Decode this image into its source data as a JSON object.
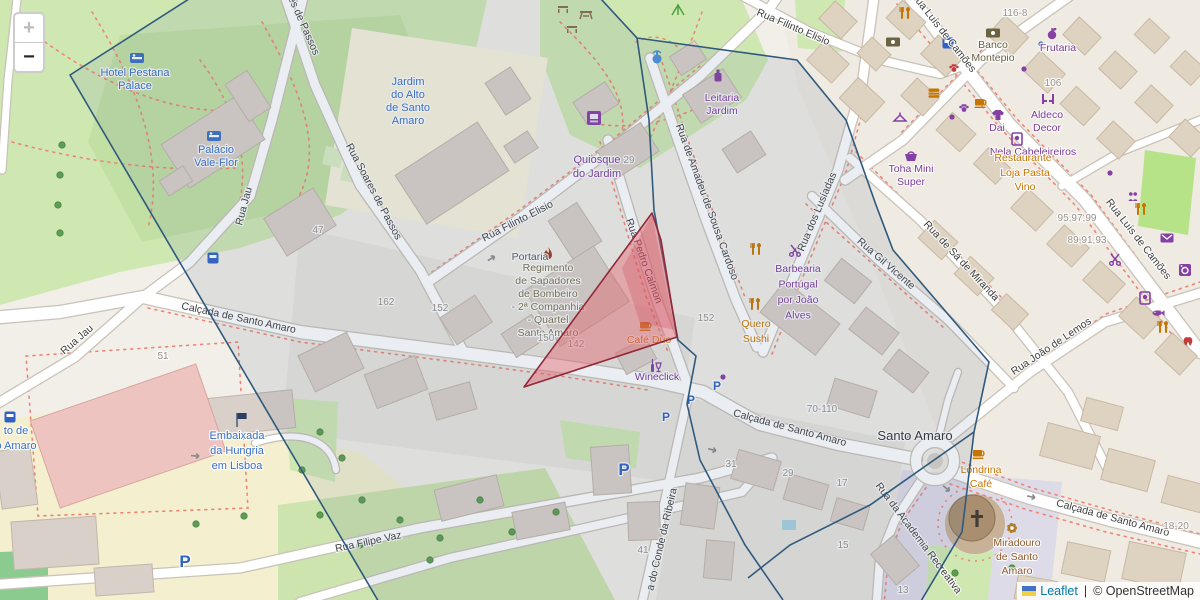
{
  "controls": {
    "zoom_in": "+",
    "zoom_out": "−",
    "zoom_in_enabled": false,
    "zoom_out_enabled": true
  },
  "attribution": {
    "leaflet_link": "Leaflet",
    "separator": "|",
    "copyright": "© OpenStreetMap",
    "flag_icon": "ukraine-flag"
  },
  "colors": {
    "street": "#3e3e3e",
    "shop": "#7a3b99",
    "food": "#c77400",
    "blue": "#3a6fc4",
    "olive": "#6b6243",
    "mil": "#7b6f4d",
    "gray": "#5a5a52",
    "brown": "#8d5b2a",
    "place": "#35343a",
    "num": "#97918a",
    "parking": "#2f62c4",
    "overlay_blue_stroke": "#2f5a7d",
    "overlay_blue_fill": "rgba(90,115,150,0.13)",
    "overlay_red_stroke": "#93283a",
    "overlay_red_fill": "rgba(228,92,103,0.42)"
  },
  "labels": {
    "streets": [
      {
        "t": "Rua Jau",
        "x": 79,
        "y": 342,
        "r": -41
      },
      {
        "t": "Rua Jau",
        "x": 247,
        "y": 207,
        "r": -75
      },
      {
        "t": "es de Passos",
        "x": 301,
        "y": 27,
        "r": 66
      },
      {
        "t": "Rua Soares de Passos",
        "x": 371,
        "y": 193,
        "r": 62
      },
      {
        "t": "Rua Filinto Elisio",
        "x": 519,
        "y": 224,
        "r": -27
      },
      {
        "t": "Rua Filinto Elisio",
        "x": 792,
        "y": 30,
        "r": 23
      },
      {
        "t": "Rua Pedro Calmon",
        "x": 641,
        "y": 262,
        "r": 70
      },
      {
        "t": "Rua de Amadeu de Sousa Cardoso",
        "x": 704,
        "y": 203,
        "r": 70
      },
      {
        "t": "Rua dos Lusíadas",
        "x": 820,
        "y": 213,
        "r": -67
      },
      {
        "t": "Rua Gil Vicente",
        "x": 884,
        "y": 266,
        "r": 41
      },
      {
        "t": "Rua de Sá de Miranda",
        "x": 959,
        "y": 263,
        "r": 47
      },
      {
        "t": "Rua João de Lemos",
        "x": 1053,
        "y": 349,
        "r": -34
      },
      {
        "t": "Rua Luís de Camões",
        "x": 941,
        "y": 34,
        "r": 52
      },
      {
        "t": "Rua Luís de Camões",
        "x": 1136,
        "y": 241,
        "r": 52
      },
      {
        "t": "Calçada de Santo Amaro",
        "x": 238,
        "y": 321,
        "r": 12
      },
      {
        "t": "Calçada de Santo Amaro",
        "x": 789,
        "y": 431,
        "r": 15
      },
      {
        "t": "Calçada de Santo Amaro",
        "x": 1112,
        "y": 521,
        "r": 15
      },
      {
        "t": "Rua Filipe Vaz",
        "x": 369,
        "y": 545,
        "r": -12
      },
      {
        "t": "a do Conde da Ribeira",
        "x": 665,
        "y": 540,
        "r": -77
      },
      {
        "t": "Rua da Academia Recreativa",
        "x": 916,
        "y": 540,
        "r": 53
      }
    ],
    "pois": [
      {
        "l": [
          "Hotel Pestana",
          "Palace"
        ],
        "x": 135,
        "y": 76,
        "lh": 13,
        "c": "blue",
        "s": 11
      },
      {
        "l": [
          "Palácio",
          "Vale-Flor"
        ],
        "x": 216,
        "y": 153,
        "lh": 13,
        "c": "blue",
        "s": 11
      },
      {
        "l": [
          "Jardim",
          "do Alto",
          "de Santo",
          "Amaro"
        ],
        "x": 408,
        "y": 85,
        "lh": 13,
        "c": "blue",
        "s": 11
      },
      {
        "l": [
          "Embaixada",
          "da Hungria",
          "em Lisboa"
        ],
        "x": 237,
        "y": 439,
        "lh": 15,
        "c": "blue",
        "s": 11
      },
      {
        "l": [
          "to de",
          "o Amaro"
        ],
        "x": 16,
        "y": 434,
        "lh": 15,
        "c": "blue",
        "s": 11
      },
      {
        "l": [
          "Quiosque",
          "do Jardim"
        ],
        "x": 597,
        "y": 163,
        "lh": 14,
        "c": "shop",
        "s": 11
      },
      {
        "l": [
          "Leitaria",
          "Jardim"
        ],
        "x": 722,
        "y": 101,
        "lh": 13,
        "c": "shop",
        "s": 10.5
      },
      {
        "l": [
          "Frutaria"
        ],
        "x": 1058,
        "y": 51,
        "lh": 13,
        "c": "shop",
        "s": 10.5
      },
      {
        "l": [
          "Aldeco",
          "Decor"
        ],
        "x": 1047,
        "y": 118,
        "lh": 13,
        "c": "shop",
        "s": 10.5
      },
      {
        "l": [
          "Dai"
        ],
        "x": 997,
        "y": 131,
        "lh": 12,
        "c": "shop",
        "s": 10.5
      },
      {
        "l": [
          "Nela Cabeleireiros"
        ],
        "x": 1033,
        "y": 155,
        "lh": 12,
        "c": "shop",
        "s": 10.5
      },
      {
        "l": [
          "Toha Mini",
          "Super"
        ],
        "x": 911,
        "y": 172,
        "lh": 13,
        "c": "shop",
        "s": 10.5
      },
      {
        "l": [
          "Barbearia",
          "Portugal",
          "por João",
          "Alves"
        ],
        "x": 798,
        "y": 272,
        "lh": 15.5,
        "c": "shop",
        "s": 10.5
      },
      {
        "l": [
          "Wineclick"
        ],
        "x": 657,
        "y": 380,
        "lh": 12,
        "c": "shop",
        "s": 10.5
      },
      {
        "l": [
          "Banco",
          "Montepio"
        ],
        "x": 993,
        "y": 48,
        "lh": 13,
        "c": "olive",
        "s": 10.5
      },
      {
        "l": [
          "Regimento",
          "de Sapadores",
          "de Bombeiro",
          "- 2ª Companhia",
          "- Quartel",
          "Santo Amaro"
        ],
        "x": 548,
        "y": 271,
        "lh": 13,
        "c": "mil",
        "s": 10.5
      },
      {
        "l": [
          "Portaria"
        ],
        "x": 530,
        "y": 260,
        "lh": 12,
        "c": "gray",
        "s": 10.5
      },
      {
        "l": [
          "Café Duo"
        ],
        "x": 649,
        "y": 343,
        "lh": 12,
        "c": "food",
        "s": 10.5
      },
      {
        "l": [
          "Quero",
          "Sushi"
        ],
        "x": 756,
        "y": 327,
        "lh": 15,
        "c": "food",
        "s": 10.5
      },
      {
        "l": [
          "Londrina",
          "Café"
        ],
        "x": 981,
        "y": 473,
        "lh": 14,
        "c": "food",
        "s": 10.5
      },
      {
        "l": [
          "Restaurante"
        ],
        "x": 1023,
        "y": 161,
        "lh": 12,
        "c": "food",
        "s": 10.5
      },
      {
        "l": [
          "Loja Pasta",
          "Vino"
        ],
        "x": 1025,
        "y": 176,
        "lh": 14,
        "c": "food",
        "s": 10.5
      },
      {
        "l": [
          "Miradouro",
          "de Santo",
          "Amaro"
        ],
        "x": 1017,
        "y": 546,
        "lh": 14,
        "c": "brown",
        "s": 10.5
      },
      {
        "l": [
          "Santo Amaro"
        ],
        "x": 915,
        "y": 440,
        "lh": 14,
        "c": "place",
        "s": 13
      }
    ],
    "house_numbers": [
      {
        "t": "116-8",
        "x": 1015,
        "y": 16
      },
      {
        "t": "106",
        "x": 1053,
        "y": 86
      },
      {
        "t": "95,97,99",
        "x": 1077,
        "y": 221
      },
      {
        "t": "89,91,93",
        "x": 1087,
        "y": 243
      },
      {
        "t": "29",
        "x": 629,
        "y": 163
      },
      {
        "t": "47",
        "x": 318,
        "y": 233
      },
      {
        "t": "162",
        "x": 386,
        "y": 305
      },
      {
        "t": "152",
        "x": 440,
        "y": 311
      },
      {
        "t": "152",
        "x": 706,
        "y": 321
      },
      {
        "t": "150",
        "x": 546,
        "y": 341
      },
      {
        "t": "142",
        "x": 576,
        "y": 347
      },
      {
        "t": "51",
        "x": 163,
        "y": 359
      },
      {
        "t": "31",
        "x": 731,
        "y": 467
      },
      {
        "t": "29",
        "x": 788,
        "y": 476
      },
      {
        "t": "41",
        "x": 643,
        "y": 553
      },
      {
        "t": "70-110",
        "x": 822,
        "y": 412
      },
      {
        "t": "17",
        "x": 842,
        "y": 486
      },
      {
        "t": "15",
        "x": 843,
        "y": 548
      },
      {
        "t": "13",
        "x": 903,
        "y": 593
      },
      {
        "t": "18-20",
        "x": 1176,
        "y": 529
      }
    ],
    "parking": [
      {
        "t": "P",
        "x": 624,
        "y": 475,
        "s": 17
      },
      {
        "t": "P",
        "x": 666,
        "y": 421,
        "s": 12
      },
      {
        "t": "P",
        "x": 691,
        "y": 404,
        "s": 12
      },
      {
        "t": "P",
        "x": 717,
        "y": 390,
        "s": 12
      },
      {
        "t": "P",
        "x": 185,
        "y": 567,
        "s": 17
      }
    ]
  },
  "icons": [
    {
      "k": "bed",
      "x": 137,
      "y": 58,
      "c": "#3a6fc4"
    },
    {
      "k": "bed",
      "x": 214,
      "y": 136,
      "c": "#3a6fc4"
    },
    {
      "k": "bench",
      "x": 563,
      "y": 8,
      "c": "#8a6d4e"
    },
    {
      "k": "picnic",
      "x": 586,
      "y": 14,
      "c": "#8a6d4e"
    },
    {
      "k": "bench",
      "x": 572,
      "y": 28,
      "c": "#8a6d4e"
    },
    {
      "k": "playground",
      "x": 678,
      "y": 10,
      "c": "#4f9e43"
    },
    {
      "k": "fountain",
      "x": 657,
      "y": 57,
      "c": "#4a90d9"
    },
    {
      "k": "kiosk",
      "x": 594,
      "y": 118,
      "c": "#8440a5"
    },
    {
      "k": "bottle",
      "x": 718,
      "y": 76,
      "c": "#8440a5"
    },
    {
      "k": "cutlery",
      "x": 905,
      "y": 13,
      "c": "#c77400"
    },
    {
      "k": "banknote",
      "x": 893,
      "y": 42,
      "c": "#6b6243"
    },
    {
      "k": "bus",
      "x": 948,
      "y": 43,
      "c": "#2f62c4"
    },
    {
      "k": "banknote",
      "x": 993,
      "y": 33,
      "c": "#6b6243"
    },
    {
      "k": "paw",
      "x": 954,
      "y": 68,
      "c": "#c43b3b"
    },
    {
      "k": "fruit",
      "x": 1052,
      "y": 34,
      "c": "#8440a5"
    },
    {
      "k": "dot",
      "x": 1041,
      "y": 44,
      "c": "#3a6fc4"
    },
    {
      "k": "dot",
      "x": 1024,
      "y": 69,
      "c": "#8440a5"
    },
    {
      "k": "burger",
      "x": 934,
      "y": 93,
      "c": "#c77400"
    },
    {
      "k": "cup",
      "x": 980,
      "y": 102,
      "c": "#c77400"
    },
    {
      "k": "paw",
      "x": 964,
      "y": 108,
      "c": "#8440a5"
    },
    {
      "k": "dot",
      "x": 952,
      "y": 117,
      "c": "#8440a5"
    },
    {
      "k": "shirt",
      "x": 998,
      "y": 115,
      "c": "#8440a5"
    },
    {
      "k": "hanger",
      "x": 900,
      "y": 118,
      "c": "#8440a5"
    },
    {
      "k": "chairs",
      "x": 1048,
      "y": 99,
      "c": "#8440a5"
    },
    {
      "k": "basket",
      "x": 911,
      "y": 156,
      "c": "#8440a5"
    },
    {
      "k": "mirror",
      "x": 1017,
      "y": 139,
      "c": "#8440a5"
    },
    {
      "k": "scissors",
      "x": 795,
      "y": 251,
      "c": "#8440a5"
    },
    {
      "k": "cutlery",
      "x": 756,
      "y": 249,
      "c": "#c77400"
    },
    {
      "k": "cutlery",
      "x": 755,
      "y": 304,
      "c": "#c77400"
    },
    {
      "k": "wine",
      "x": 655,
      "y": 366,
      "c": "#8440a5"
    },
    {
      "k": "cup",
      "x": 645,
      "y": 325,
      "c": "#c77400"
    },
    {
      "k": "flame",
      "x": 548,
      "y": 254,
      "c": "#a03a28"
    },
    {
      "k": "flag",
      "x": 237,
      "y": 420,
      "c": "#2b3f66"
    },
    {
      "k": "tram",
      "x": 10,
      "y": 417,
      "c": "#2f62c4"
    },
    {
      "k": "cup",
      "x": 978,
      "y": 453,
      "c": "#c77400"
    },
    {
      "k": "flower",
      "x": 1012,
      "y": 528,
      "c": "#b07d2b"
    },
    {
      "k": "envelope",
      "x": 1167,
      "y": 238,
      "c": "#8440a5"
    },
    {
      "k": "washer",
      "x": 1185,
      "y": 270,
      "c": "#8440a5"
    },
    {
      "k": "mirror",
      "x": 1145,
      "y": 298,
      "c": "#8440a5"
    },
    {
      "k": "fish",
      "x": 1158,
      "y": 313,
      "c": "#8440a5"
    },
    {
      "k": "cutlery",
      "x": 1163,
      "y": 327,
      "c": "#c77400"
    },
    {
      "k": "tooth",
      "x": 1188,
      "y": 342,
      "c": "#c43b3b"
    },
    {
      "k": "scissors",
      "x": 1115,
      "y": 260,
      "c": "#8440a5"
    },
    {
      "k": "people",
      "x": 1133,
      "y": 197,
      "c": "#8440a5"
    },
    {
      "k": "cutlery",
      "x": 1141,
      "y": 209,
      "c": "#c77400"
    },
    {
      "k": "dot",
      "x": 1110,
      "y": 173,
      "c": "#8440a5"
    },
    {
      "k": "dot",
      "x": 723,
      "y": 377,
      "c": "#8440a5"
    },
    {
      "k": "bus",
      "x": 213,
      "y": 258,
      "c": "#2f62c4"
    },
    {
      "k": "cross",
      "x": 977,
      "y": 518,
      "c": "#423d36"
    },
    {
      "k": "arrow",
      "x": 492,
      "y": 258,
      "c": "#8a8a8a",
      "r": -33
    },
    {
      "k": "arrow",
      "x": 196,
      "y": 456,
      "c": "#8a8a8a",
      "r": 5
    },
    {
      "k": "arrow",
      "x": 713,
      "y": 450,
      "c": "#8a8a8a",
      "r": 15
    },
    {
      "k": "arrow",
      "x": 908,
      "y": 437,
      "c": "#8a8a8a",
      "r": -25
    },
    {
      "k": "arrow",
      "x": 1032,
      "y": 497,
      "c": "#8a8a8a",
      "r": 12
    },
    {
      "k": "arrow",
      "x": 947,
      "y": 489,
      "c": "#8a8a8a",
      "r": 40
    },
    {
      "k": "pool",
      "x": 789,
      "y": 525,
      "c": "#a8d2e0"
    }
  ],
  "trees": [
    [
      62,
      145
    ],
    [
      60,
      175
    ],
    [
      58,
      205
    ],
    [
      60,
      233
    ],
    [
      320,
      432
    ],
    [
      302,
      470
    ],
    [
      342,
      458
    ],
    [
      362,
      500
    ],
    [
      320,
      515
    ],
    [
      400,
      520
    ],
    [
      440,
      538
    ],
    [
      480,
      500
    ],
    [
      244,
      516
    ],
    [
      196,
      524
    ],
    [
      512,
      532
    ],
    [
      556,
      512
    ],
    [
      430,
      560
    ],
    [
      360,
      545
    ],
    [
      955,
      573
    ],
    [
      1012,
      568
    ]
  ]
}
